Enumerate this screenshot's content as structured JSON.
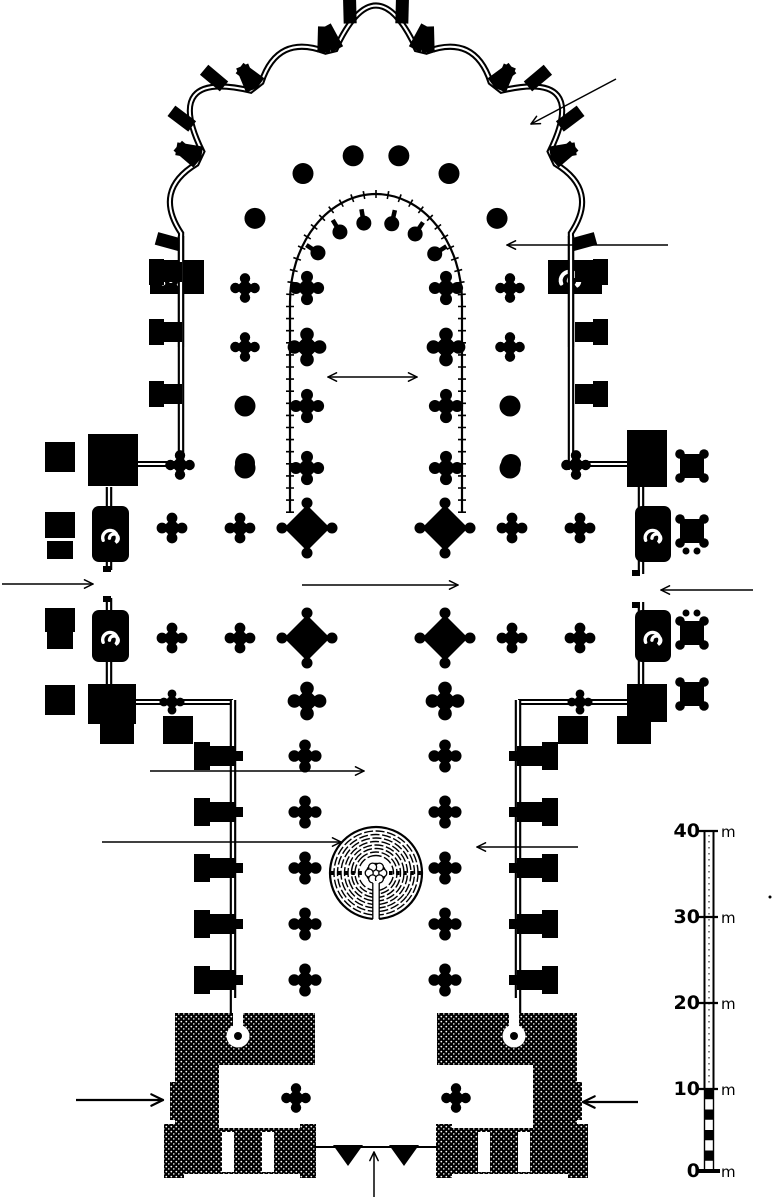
{
  "figure": {
    "kind": "architectural-floor-plan",
    "subject": "gothic-cathedral-ground-plan-with-labyrinth",
    "ink_color": "#000000",
    "paper_color": "#ffffff"
  },
  "scale_bar": {
    "unit_label": "m",
    "bar_x": 709,
    "ticks": [
      {
        "label": "40",
        "y": 831
      },
      {
        "label": "30",
        "y": 917
      },
      {
        "label": "20",
        "y": 1003
      },
      {
        "label": "10",
        "y": 1089
      },
      {
        "label": "0",
        "y": 1171
      }
    ],
    "hatched_segment": {
      "from_label": "10",
      "to_label": "0"
    }
  },
  "annotations": {
    "arrows": [
      {
        "id": "arrow-northeast-chapel",
        "x1": 616,
        "y1": 79,
        "x2": 531,
        "y2": 124,
        "style": "thin"
      },
      {
        "id": "arrow-ambulatory",
        "x1": 668,
        "y1": 245,
        "x2": 507,
        "y2": 245,
        "style": "thin"
      },
      {
        "id": "arrow-choir-width",
        "x1": 328,
        "y1": 377,
        "x2": 417,
        "y2": 377,
        "style": "double"
      },
      {
        "id": "arrow-north-transept-portal",
        "x1": 2,
        "y1": 584,
        "x2": 93,
        "y2": 584,
        "style": "thin"
      },
      {
        "id": "arrow-south-transept-portal",
        "x1": 753,
        "y1": 590,
        "x2": 661,
        "y2": 590,
        "style": "thin"
      },
      {
        "id": "arrow-crossing",
        "x1": 302,
        "y1": 585,
        "x2": 458,
        "y2": 585,
        "style": "thin"
      },
      {
        "id": "arrow-nave",
        "x1": 150,
        "y1": 771,
        "x2": 364,
        "y2": 771,
        "style": "thin"
      },
      {
        "id": "arrow-labyrinth",
        "x1": 102,
        "y1": 842,
        "x2": 341,
        "y2": 842,
        "style": "thin"
      },
      {
        "id": "arrow-south-aisle",
        "x1": 578,
        "y1": 847,
        "x2": 477,
        "y2": 847,
        "style": "thin"
      },
      {
        "id": "arrow-northwest-tower",
        "x1": 76,
        "y1": 1100,
        "x2": 163,
        "y2": 1100,
        "style": "bold"
      },
      {
        "id": "arrow-southwest-tower",
        "x1": 638,
        "y1": 1102,
        "x2": 583,
        "y2": 1102,
        "style": "bold"
      },
      {
        "id": "arrow-west-portal",
        "x1": 374,
        "y1": 1197,
        "x2": 374,
        "y2": 1152,
        "style": "thin"
      }
    ]
  }
}
